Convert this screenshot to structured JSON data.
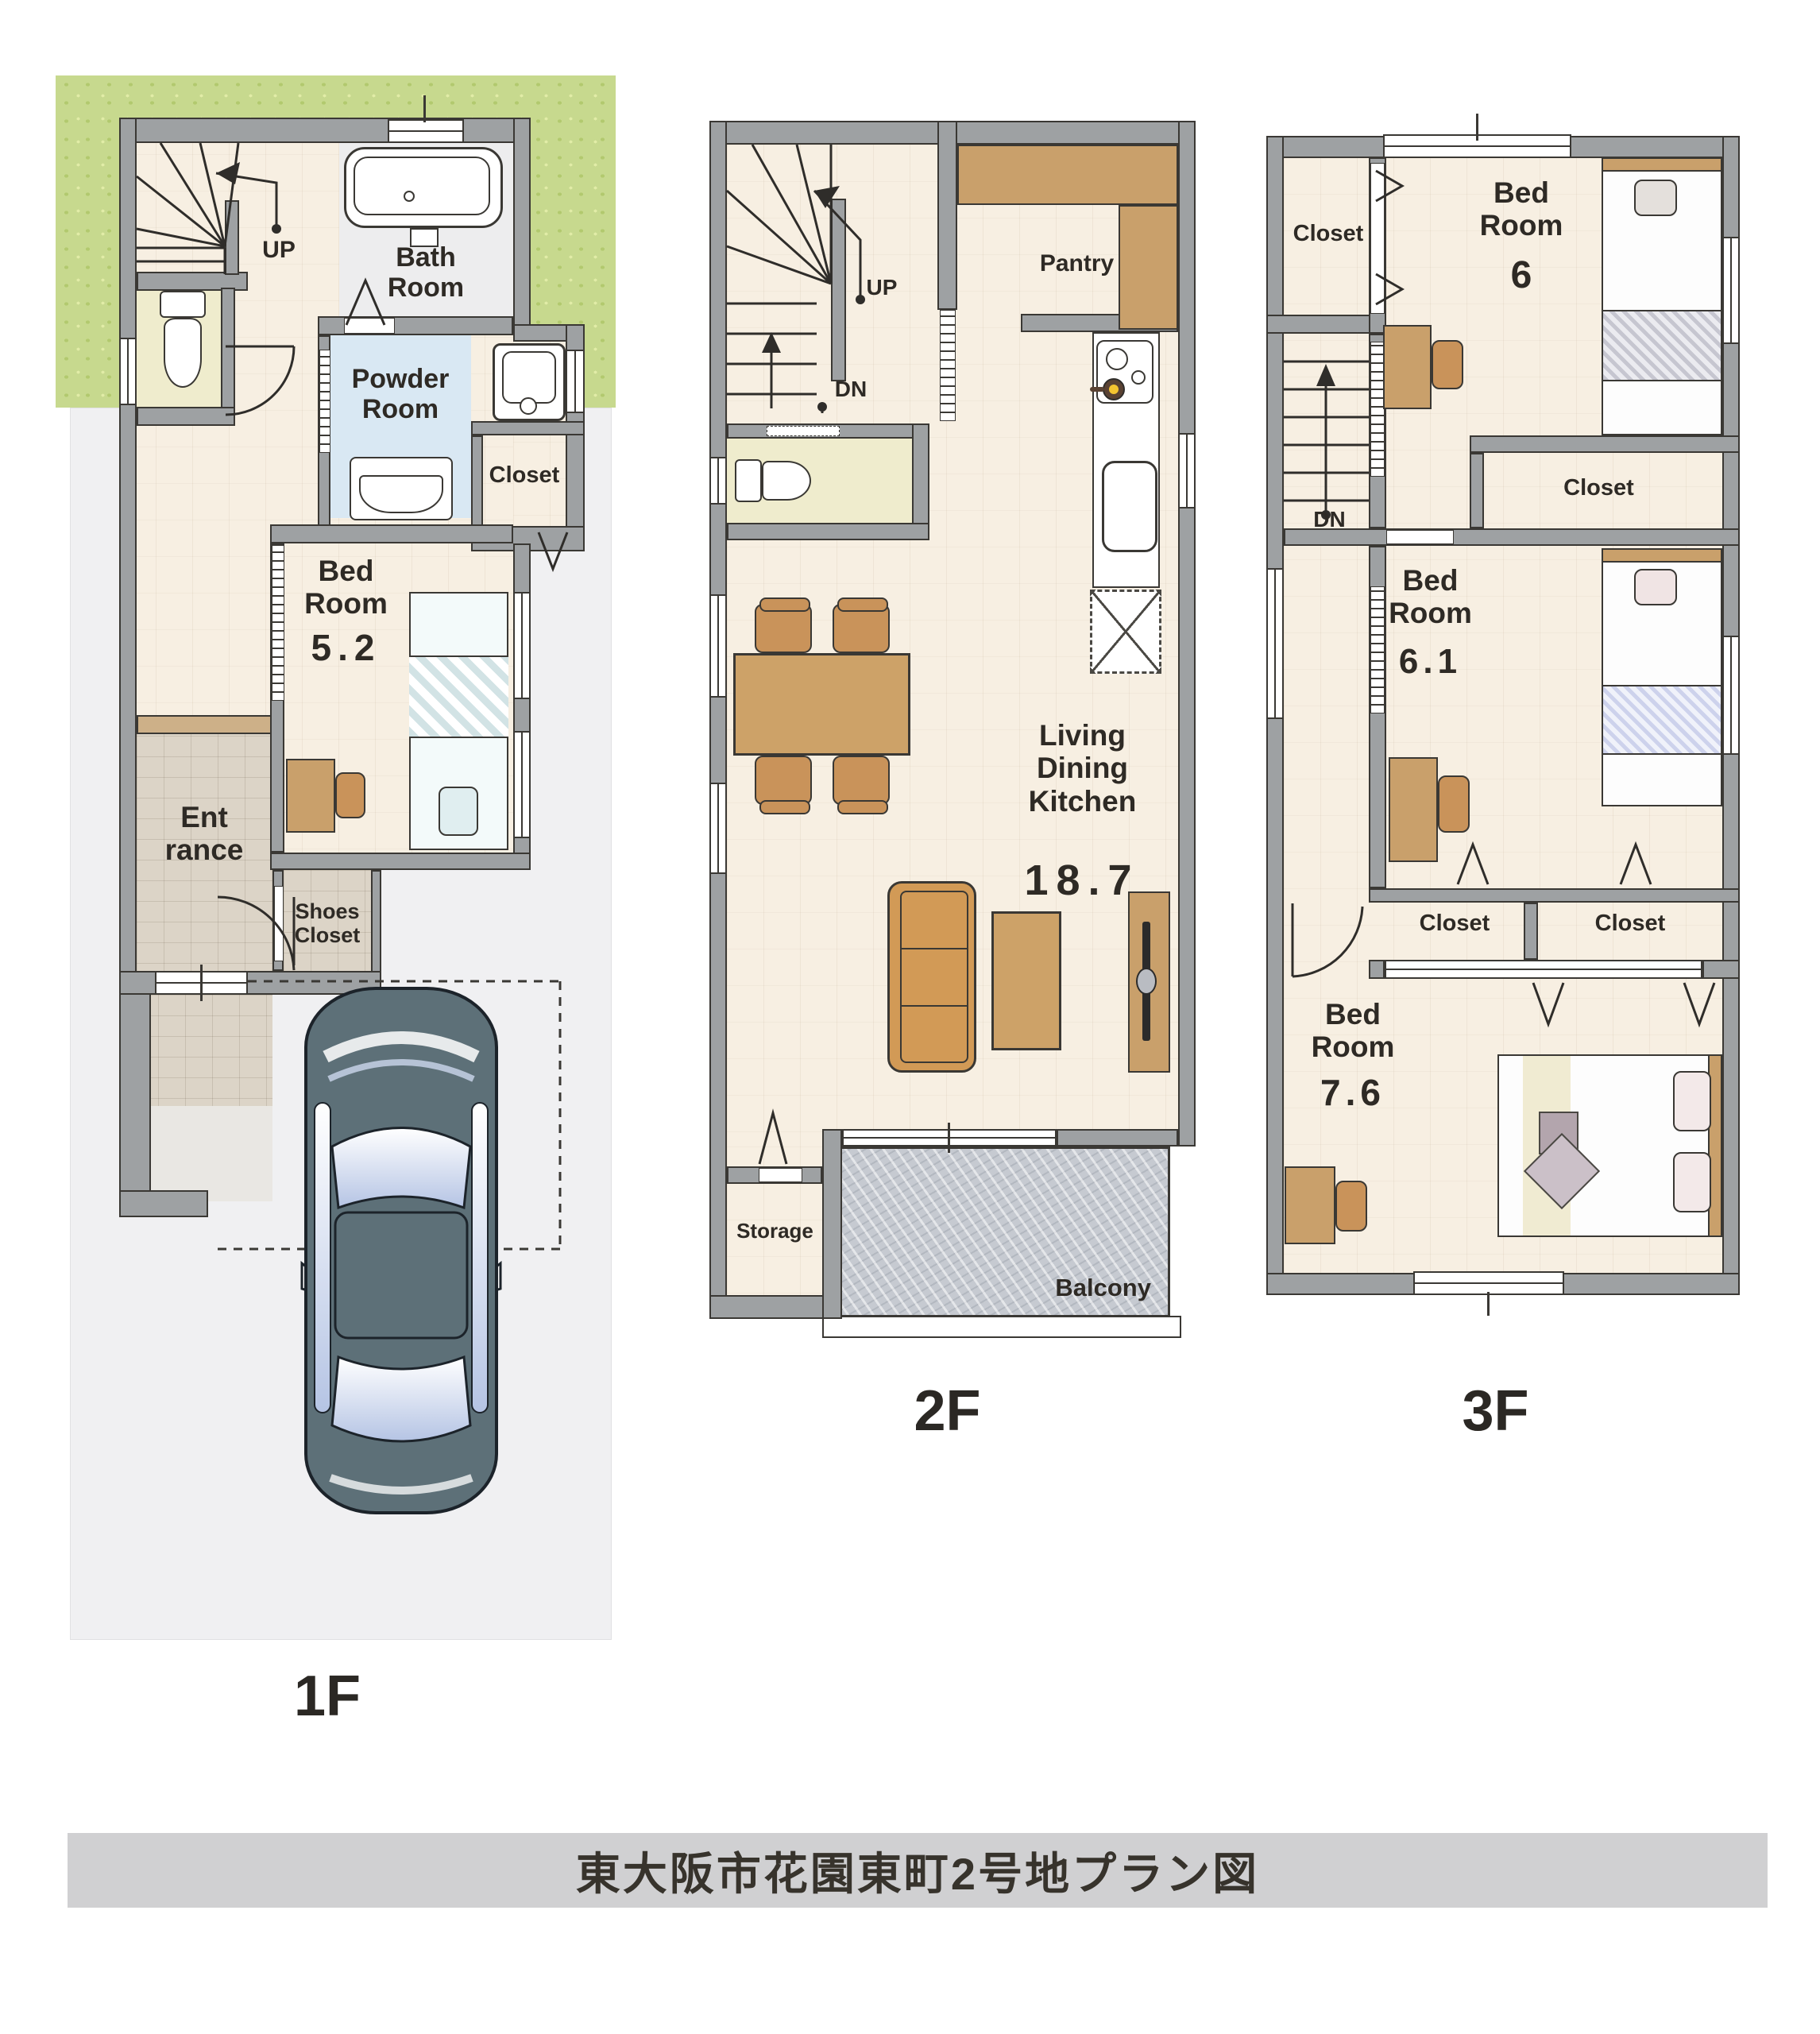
{
  "title": "東大阪市花園東町2号地プラン図",
  "floor1": {
    "label": "1F",
    "stairs_up": "UP",
    "bath_room": "Bath Room",
    "powder_room": "Powder Room",
    "closet": "Closet",
    "bedroom": {
      "name": "Bed Room",
      "size": "5.2"
    },
    "entrance": "Ent rance",
    "shoes_closet": "Shoes Closet"
  },
  "floor2": {
    "label": "2F",
    "stairs_up": "UP",
    "stairs_dn": "DN",
    "pantry": "Pantry",
    "ldk": {
      "name": "Living Dining Kitchen",
      "size": "18.7"
    },
    "storage": "Storage",
    "balcony": "Balcony"
  },
  "floor3": {
    "label": "3F",
    "stairs_dn": "DN",
    "closet_top": "Closet",
    "closet_mid": "Closet",
    "closet_bottom_left": "Closet",
    "closet_bottom_right": "Closet",
    "bedroom6": {
      "name": "Bed Room",
      "size": "6"
    },
    "bedroom61": {
      "name": "Bed Room",
      "size": "6.1"
    },
    "bedroom76": {
      "name": "Bed Room",
      "size": "7.6"
    }
  },
  "colors": {
    "wall": "#9ea1a3",
    "wood_floor": "#f7efe2",
    "tile_floor": "#dcd4c7",
    "garden": "#c7d98e",
    "driveway": "#f0f0f2",
    "powder_room_floor": "#d9e8f3",
    "toilet_room_floor": "#efeccd",
    "balcony_floor": "#c6cad1",
    "furniture_wood": "#c9a06b",
    "sofa": "#d29a56",
    "car_body": "#5d7078",
    "title_bar": "#d0d0d2"
  }
}
